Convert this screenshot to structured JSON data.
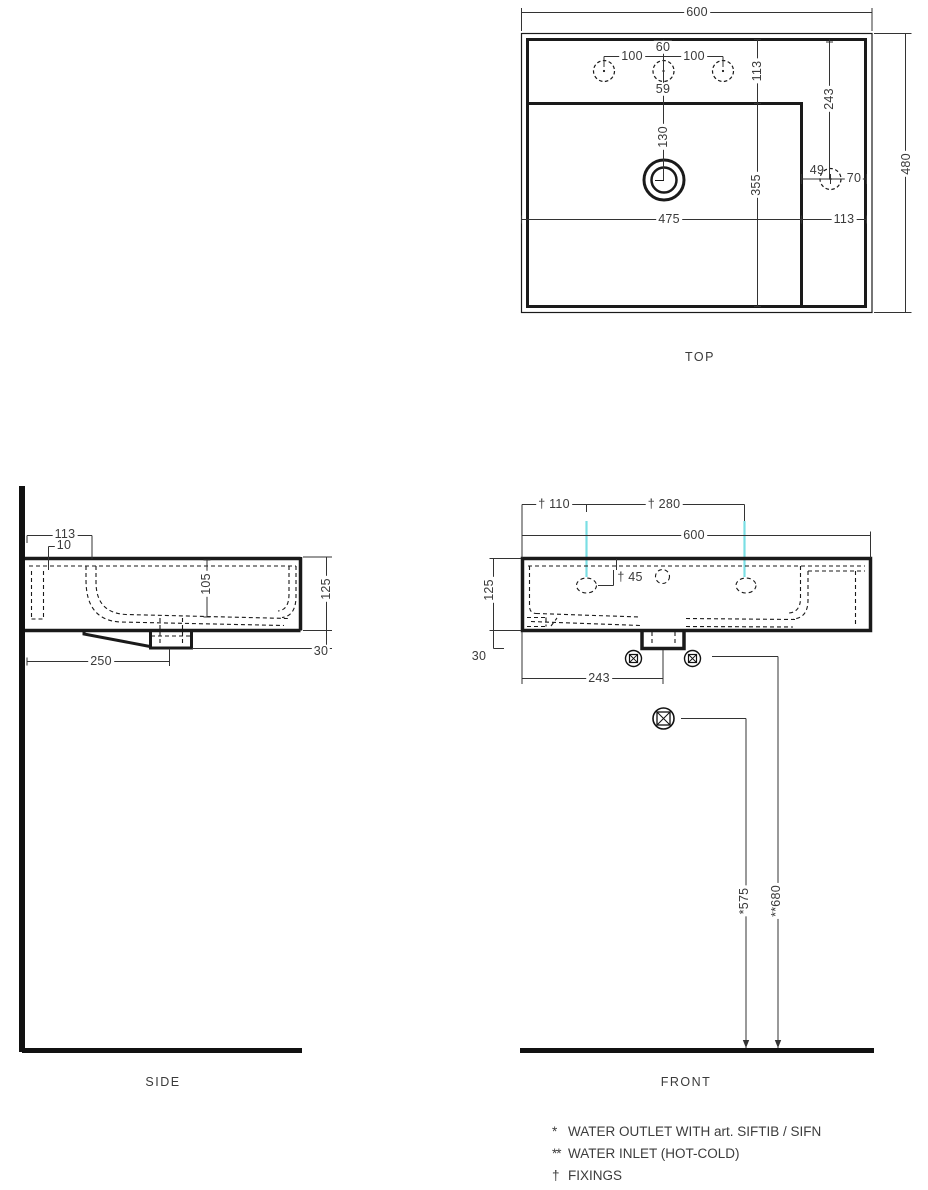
{
  "colors": {
    "line": "#1a1a1a",
    "dim_line": "#333333",
    "text": "#3a3a3a",
    "fixing_accent": "#7adee4"
  },
  "top_view": {
    "title": "TOP",
    "d600": "600",
    "d480": "480",
    "d100L": "100",
    "d100R": "100",
    "d60": "60",
    "d59": "59",
    "d113v": "113",
    "d243": "243",
    "d130": "130",
    "d355": "355",
    "d49": "49",
    "d70": "70",
    "d475": "475",
    "d113h": "113"
  },
  "side_view": {
    "title": "SIDE",
    "d113": "113",
    "d10": "10",
    "d105": "105",
    "d125": "125",
    "d30": "30",
    "d250": "250"
  },
  "front_view": {
    "title": "FRONT",
    "f110": "† 110",
    "f280": "† 280",
    "d600": "600",
    "d125": "125",
    "d30": "30",
    "f45": "† 45",
    "d243": "243",
    "d575": "*575",
    "d680": "**680"
  },
  "legend": {
    "items": [
      {
        "symbol": "*",
        "text": "WATER OUTLET WITH art. SIFTIB / SIFN"
      },
      {
        "symbol": "**",
        "text": "WATER INLET (HOT-COLD)"
      },
      {
        "symbol": "†",
        "text": "FIXINGS"
      }
    ]
  }
}
